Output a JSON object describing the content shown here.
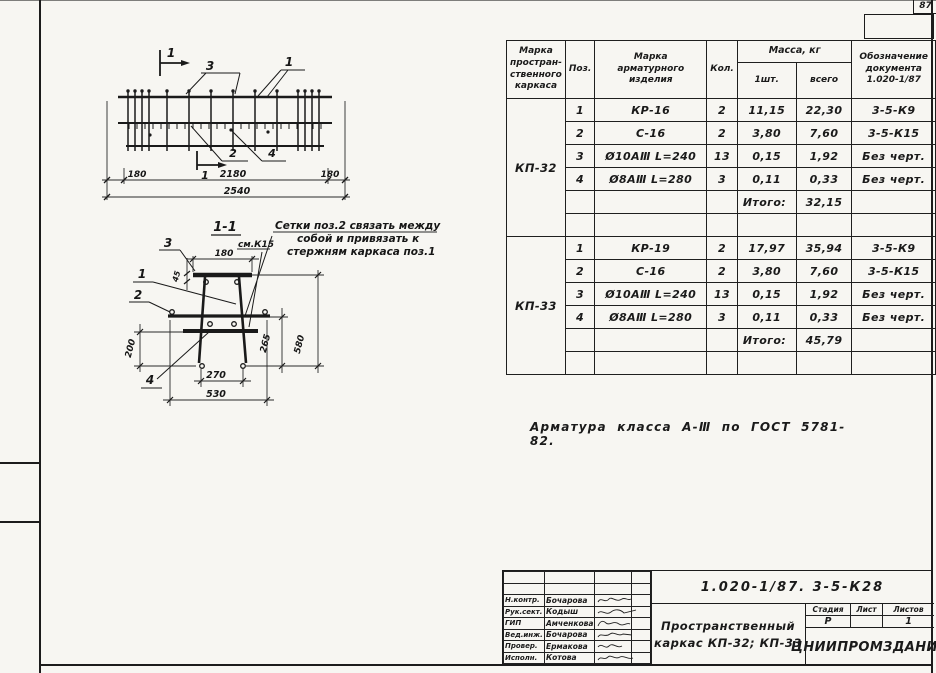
{
  "page_number": "87",
  "material_note": "Арматура  класса  А-Ⅲ  по  ГОСТ 5781-82.",
  "elevation": {
    "marker_label": "1",
    "callout_1": "1",
    "callout_2": "2",
    "callout_3": "3",
    "callout_4": "4",
    "dim_left": "180",
    "dim_mid": "2180",
    "dim_right": "180",
    "dim_total": "2540"
  },
  "section": {
    "title": "1-1",
    "ref": "см.К15",
    "note1": "Сетки поз.2 связать между",
    "note2": "собой и привязать к",
    "note3": "стержням каркаса поз.1",
    "callout_1": "1",
    "callout_2": "2",
    "callout_3": "3",
    "callout_4": "4",
    "dim_top": "180",
    "dim_45": "45",
    "dim_200": "200",
    "dim_265": "265",
    "dim_580": "580",
    "dim_270": "270",
    "dim_530": "530"
  },
  "spec_table": {
    "headers": {
      "col1": "Марка\nпростран-\nственного\nкаркаса",
      "col2": "Поз.",
      "col3": "Марка\nарматурного\nизделия",
      "col4": "Кол.",
      "mass": "Масса, кг",
      "mass_unit": "1шт.",
      "mass_total": "всего",
      "col7": "Обозначение\nдокумента\n1.020-1/87"
    },
    "groups": [
      {
        "mark": "КП-32",
        "rows": [
          {
            "pos": "1",
            "item": "КР-16",
            "qty": "2",
            "unit": "11,15",
            "total": "22,30",
            "doc": "3-5-К9"
          },
          {
            "pos": "2",
            "item": "С-16",
            "qty": "2",
            "unit": "3,80",
            "total": "7,60",
            "doc": "3-5-К15"
          },
          {
            "pos": "3",
            "item": "Ø10АⅢ L=240",
            "qty": "13",
            "unit": "0,15",
            "total": "1,92",
            "doc": "Без черт."
          },
          {
            "pos": "4",
            "item": "Ø8АⅢ L=280",
            "qty": "3",
            "unit": "0,11",
            "total": "0,33",
            "doc": "Без черт."
          }
        ],
        "total_label": "Итого:",
        "total": "32,15"
      },
      {
        "mark": "КП-33",
        "rows": [
          {
            "pos": "1",
            "item": "КР-19",
            "qty": "2",
            "unit": "17,97",
            "total": "35,94",
            "doc": "3-5-К9"
          },
          {
            "pos": "2",
            "item": "С-16",
            "qty": "2",
            "unit": "3,80",
            "total": "7,60",
            "doc": "3-5-К15"
          },
          {
            "pos": "3",
            "item": "Ø10АⅢ L=240",
            "qty": "13",
            "unit": "0,15",
            "total": "1,92",
            "doc": "Без черт."
          },
          {
            "pos": "4",
            "item": "Ø8АⅢ L=280",
            "qty": "3",
            "unit": "0,11",
            "total": "0,33",
            "doc": "Без черт."
          }
        ],
        "total_label": "Итого:",
        "total": "45,79"
      }
    ]
  },
  "titleblock": {
    "doc_number": "1.020-1/87. 3-5-К28",
    "signers": [
      {
        "role": "Н.контр.",
        "name": "Бочарова"
      },
      {
        "role": "Рук.сект.",
        "name": "Кодыш"
      },
      {
        "role": "ГИП",
        "name": "Амченкова"
      },
      {
        "role": "Вед.инж.",
        "name": "Бочарова"
      },
      {
        "role": "Провер.",
        "name": "Ермакова"
      },
      {
        "role": "Исполн.",
        "name": "Котова"
      }
    ],
    "title_line1": "Пространственный",
    "title_line2": "каркас  КП-32; КП-33",
    "stage_label": "Стадия",
    "sheet_label": "Лист",
    "sheets_label": "Листов",
    "stage": "Р",
    "sheet": "",
    "sheets": "1",
    "org": "ЦНИИПРОМЗДАНИЙ"
  }
}
